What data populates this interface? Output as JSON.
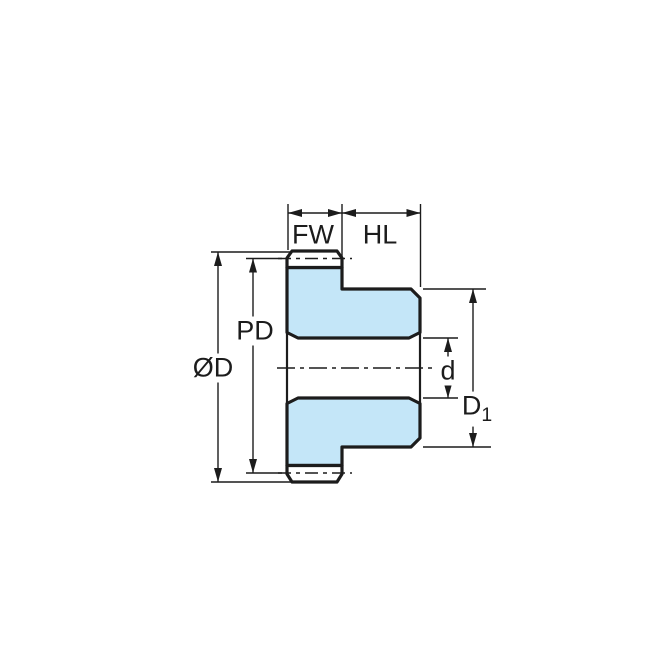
{
  "diagram": {
    "type": "gear-cross-section-dimension-drawing",
    "labels": {
      "fw": "FW",
      "hl": "HL",
      "pd": "PD",
      "od": "ØD",
      "d": "d",
      "d1_base": "D",
      "d1_sub": "1"
    },
    "colors": {
      "body_fill": "#c4e6f8",
      "line_color": "#1c1c1c"
    }
  }
}
